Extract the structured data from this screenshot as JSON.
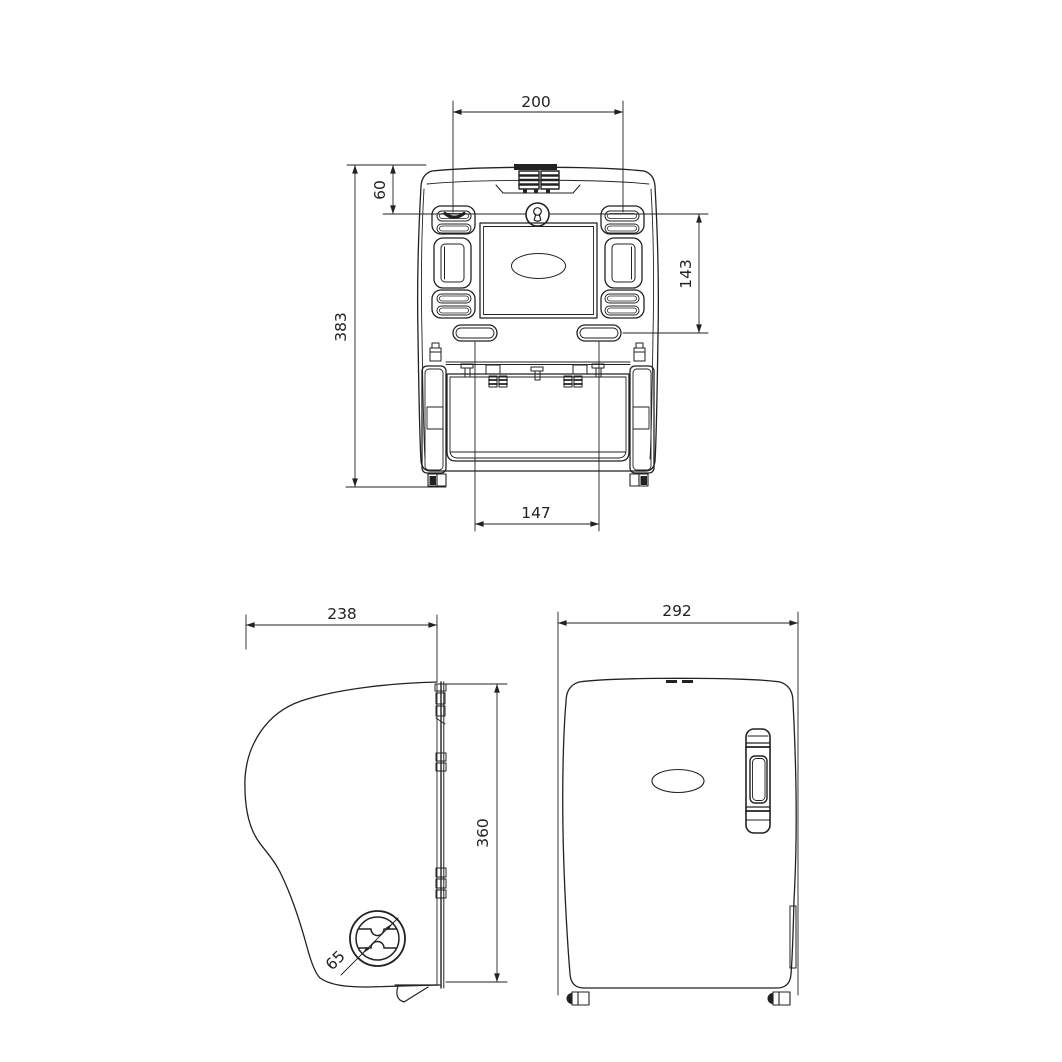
{
  "colors": {
    "line": "#222222",
    "background": "#ffffff"
  },
  "views": {
    "rear": {
      "name": "rear-view",
      "dims": {
        "mount_hole_spacing_horizontal": "200",
        "top_edge_to_holes": "60",
        "total_height": "383",
        "hole_spacing_vertical": "143",
        "lower_slot_spacing": "147"
      }
    },
    "side": {
      "name": "side-view",
      "dims": {
        "depth": "238",
        "body_height": "360",
        "lock_knob_diameter": "65"
      }
    },
    "front": {
      "name": "front-view",
      "dims": {
        "overall_width": "292"
      }
    }
  }
}
